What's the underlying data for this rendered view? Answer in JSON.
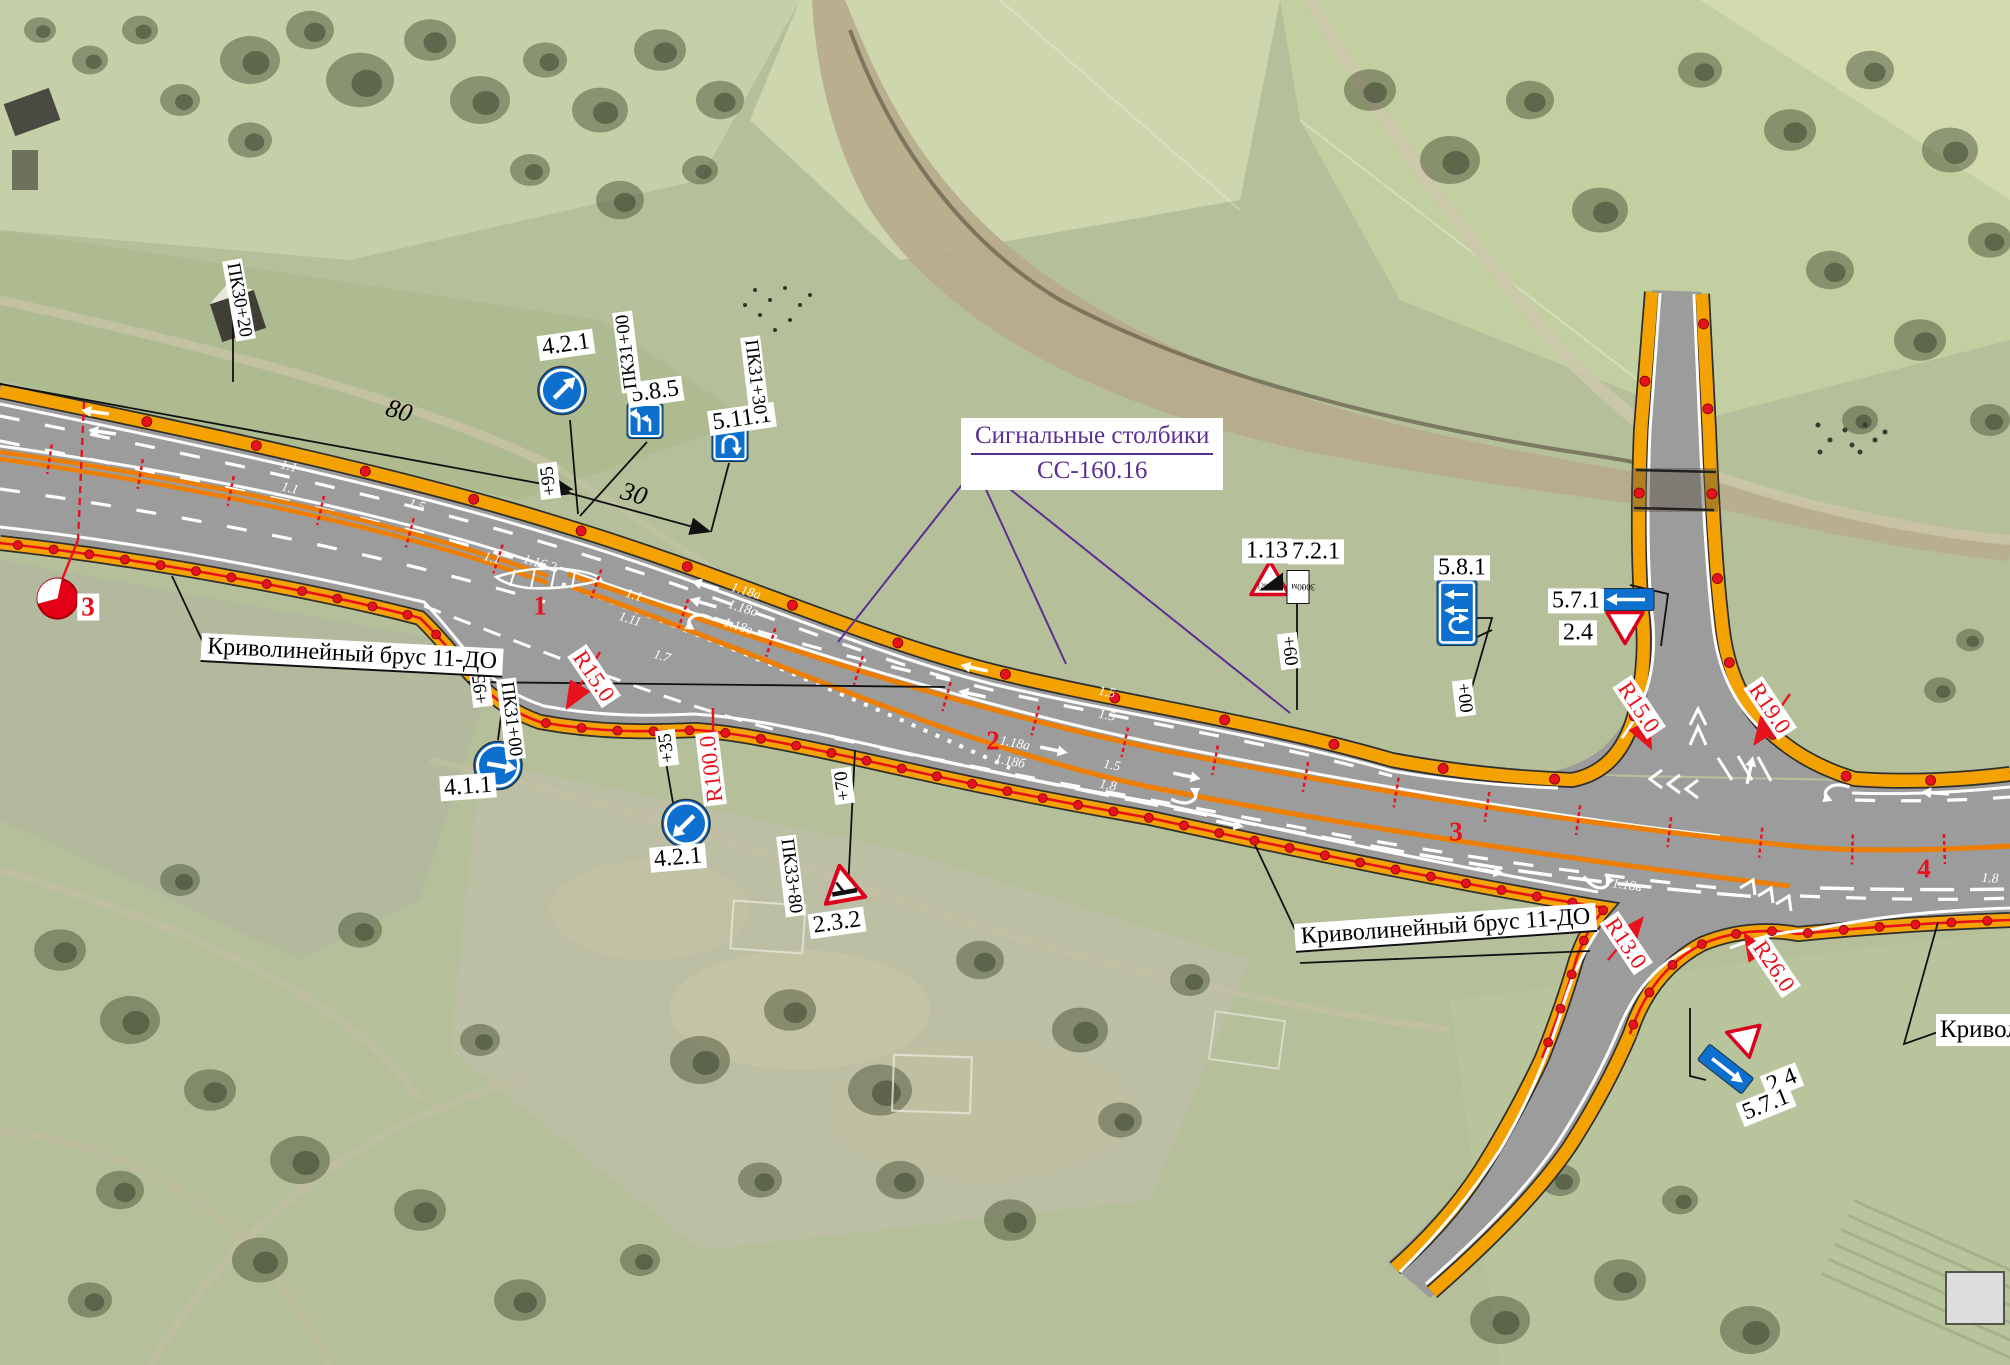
{
  "plan": {
    "labels": {
      "barrier": "Криволинейный брус 11-ДО",
      "barrier_cut": "Кривол",
      "signal_line1": "Сигнальные столбики",
      "signal_line2": "СС-160.16"
    },
    "sign_codes": {
      "c421": "4.2.1",
      "c585": "5.8.5",
      "c5111": "5.11.1",
      "c411": "4.1.1",
      "c113": "1.13",
      "c721": "7.2.1",
      "c581": "5.8.1",
      "c571": "5.7.1",
      "c24": "2.4",
      "c232": "2.3.2"
    },
    "sign_content": {
      "grade": "12%",
      "distance": "3000м",
      "arrow_up": "↑"
    },
    "stations": {
      "pk3020": "ПК30+20",
      "pk3100": "ПК31+00",
      "pk3130": "ПК31+30",
      "pk3380": "ПК33+80"
    },
    "offsets": {
      "o95": "+95",
      "o35": "+35",
      "o70": "+70",
      "o60": "+60",
      "o00": "+00"
    },
    "radii": {
      "r15": "R15.0",
      "r100": "R100.0",
      "r19": "R19.0",
      "r13": "R13.0",
      "r26": "R26.0"
    },
    "dimensions": {
      "d80": "80",
      "d30": "30"
    },
    "km_marks": {
      "k1": "1",
      "k2": "2",
      "k3": "3",
      "k4": "4",
      "post": "3"
    },
    "markings": {
      "m11": "1.1",
      "m111": "1.11",
      "m1162": "1.16.2",
      "m15": "1.5",
      "m17": "1.7",
      "m18": "1.8",
      "m118a": "1.18а",
      "m118b": "1.18б",
      "m118v": "1.18в"
    },
    "colors": {
      "overlay_red": "#e8121c",
      "band_orange": "#f3a202",
      "sign_blue": "#0d6fce",
      "leader_purple": "#5c2e91"
    }
  }
}
